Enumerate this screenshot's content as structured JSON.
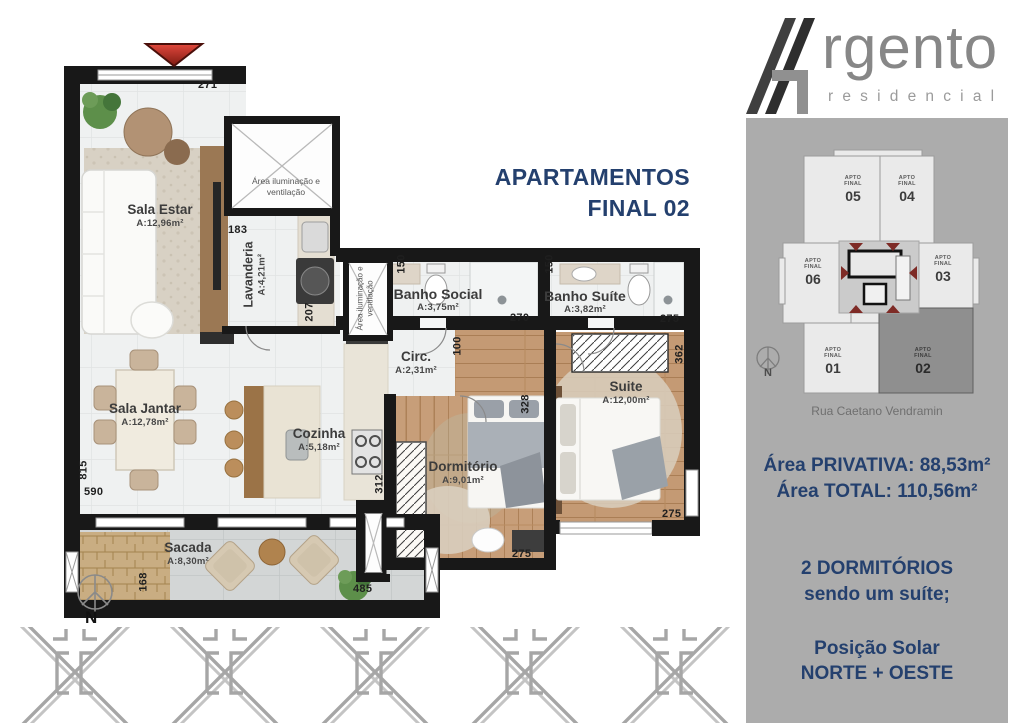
{
  "logo": {
    "brand": "rgento",
    "subtitle": "residencial"
  },
  "title": {
    "line1": "APARTAMENTOS",
    "line2": "FINAL 02"
  },
  "sidebar": {
    "key_plan": {
      "units": [
        {
          "l1": "APTO",
          "l2": "FINAL",
          "n": "05"
        },
        {
          "l1": "APTO",
          "l2": "FINAL",
          "n": "04"
        },
        {
          "l1": "APTO",
          "l2": "FINAL",
          "n": "06"
        },
        {
          "l1": "APTO",
          "l2": "FINAL",
          "n": "03"
        },
        {
          "l1": "APTO",
          "l2": "FINAL",
          "n": "01"
        },
        {
          "l1": "APTO",
          "l2": "FINAL",
          "n": "02"
        }
      ],
      "street": "Rua Caetano Vendramin",
      "compass_n": "N"
    },
    "area_privativa": "Área PRIVATIVA: 88,53m²",
    "area_total": "Área TOTAL: 110,56m²",
    "dorm_line1": "2 DORMITÓRIOS",
    "dorm_line2": "sendo um suíte;",
    "solar_line1": "Posição Solar",
    "solar_line2": "NORTE  + OESTE"
  },
  "plan": {
    "compass_n": "N",
    "shaft_label": "Área iluminação e ventilação",
    "rooms": {
      "sala_estar": {
        "name": "Sala Estar",
        "area": "A:12,96m²"
      },
      "lavanderia": {
        "name": "Lavanderia",
        "area": "A:4,21m²"
      },
      "banho_social": {
        "name": "Banho Social",
        "area": "A:3,75m²"
      },
      "banho_suite": {
        "name": "Banho Suíte",
        "area": "A:3,82m²"
      },
      "circ": {
        "name": "Circ.",
        "area": "A:2,31m²"
      },
      "suite": {
        "name": "Suite",
        "area": "A:12,00m²"
      },
      "sala_jantar": {
        "name": "Sala Jantar",
        "area": "A:12,78m²"
      },
      "cozinha": {
        "name": "Cozinha",
        "area": "A:5,18m²"
      },
      "dormitorio": {
        "name": "Dormitório",
        "area": "A:9,01m²"
      },
      "sacada": {
        "name": "Sacada",
        "area": "A:8,30m²"
      }
    },
    "dims": {
      "top": "271",
      "d183": "183",
      "d207": "207",
      "d150a": "150",
      "d270": "270",
      "d150b": "150",
      "d275a": "275",
      "d100": "100",
      "d362": "362",
      "d328": "328",
      "d815": "815",
      "d590": "590",
      "d312": "312",
      "d275b": "275",
      "d485": "485",
      "d168": "168",
      "d275c": "275"
    }
  },
  "colors": {
    "navy": "#24406e",
    "sidebar_gray": "#acacac",
    "accent_red": "#b02920",
    "wall_black": "#181818"
  }
}
